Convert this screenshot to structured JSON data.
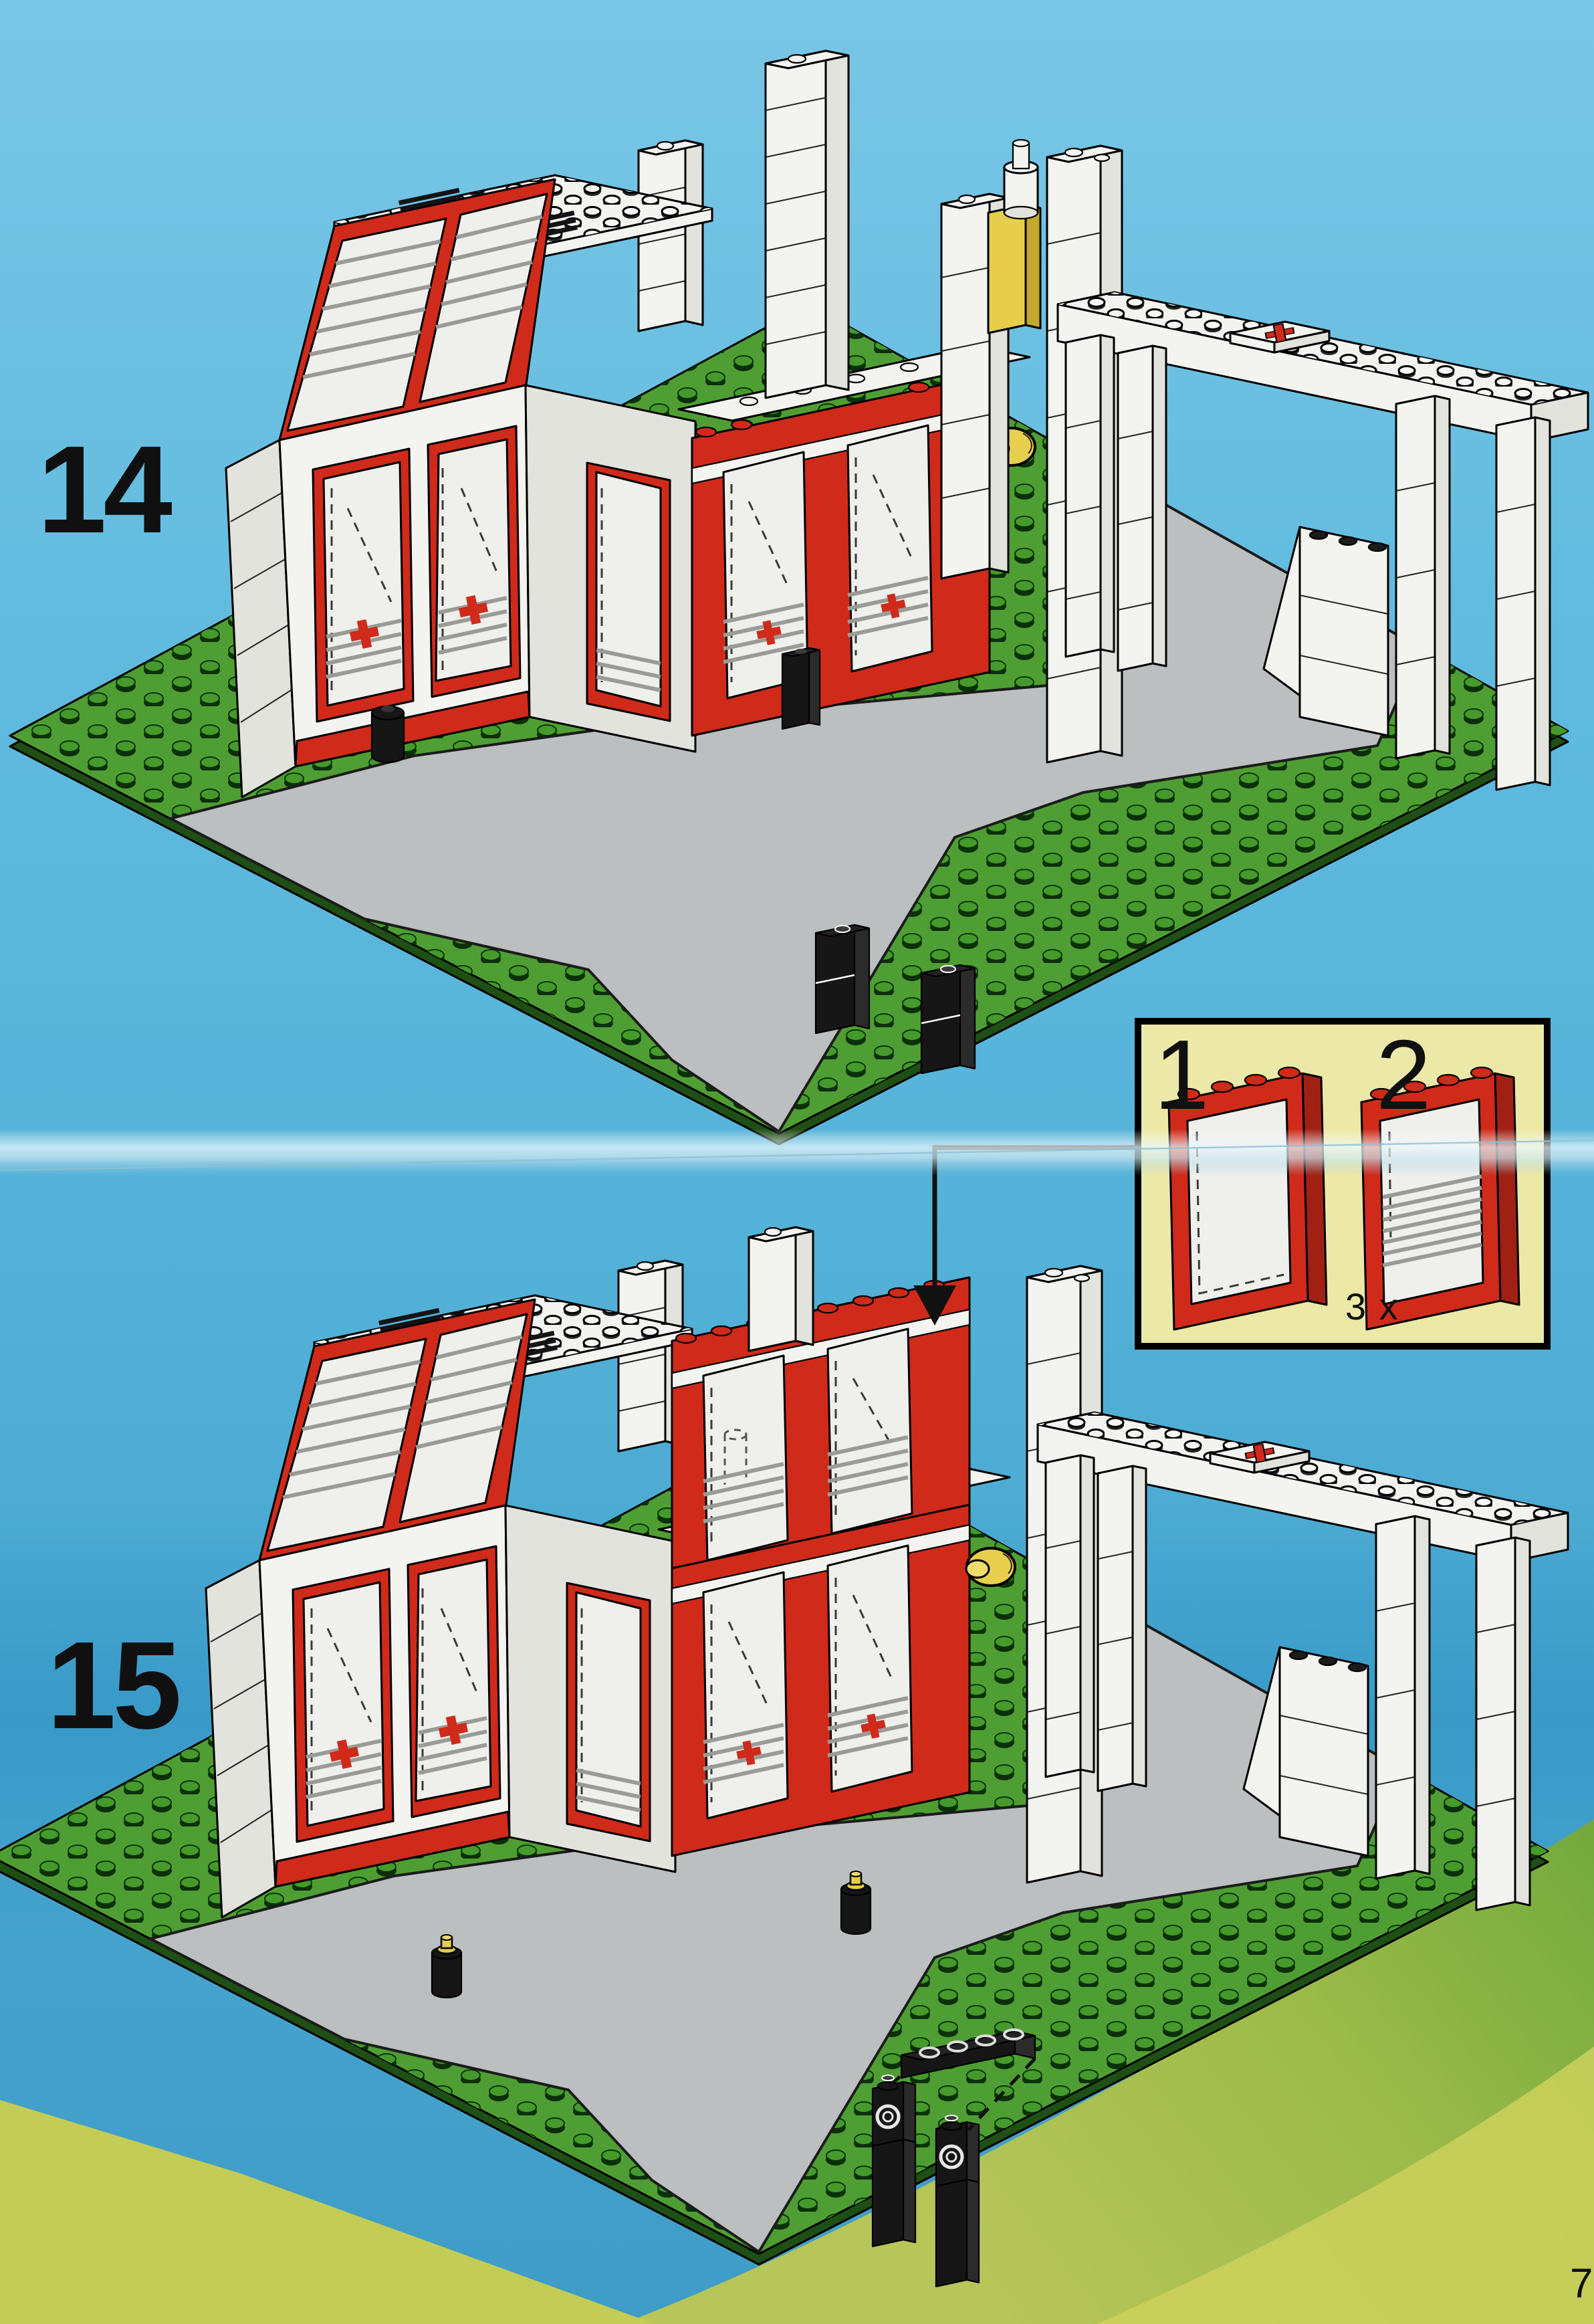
{
  "page_number": "7",
  "steps": [
    {
      "label": "14"
    },
    {
      "label": "15"
    }
  ],
  "callout": {
    "part_labels": [
      "1",
      "2"
    ],
    "quantity_label": "3 x"
  },
  "icons": {
    "red_cross_tile": "red-cross",
    "beacon_light": "beacon",
    "window_part": "red-framed-window"
  },
  "colors": {
    "sky_blue": "#5fb9dd",
    "baseplate_green": "#4f9e33",
    "road_gray": "#bcbfbf",
    "brick_red": "#cf2a1a",
    "brick_white": "#f3f3f0",
    "brick_black": "#161616",
    "beacon_yellow": "#e8cf4e",
    "callout_yellow": "#ece9a8",
    "hill_green": "#74aa3d",
    "hill_yellow_green": "#b8c558"
  }
}
